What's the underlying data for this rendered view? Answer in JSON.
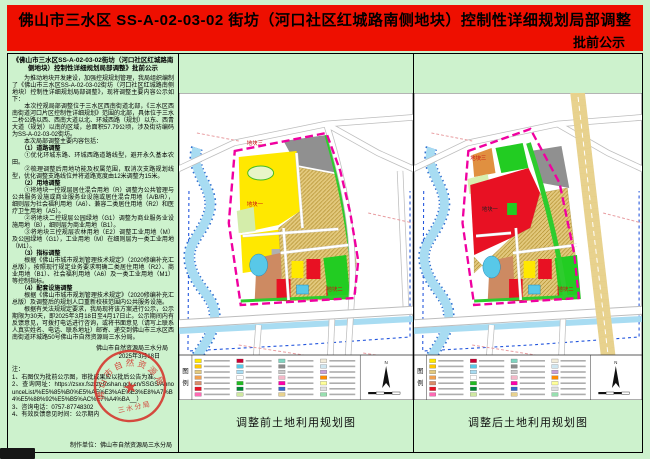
{
  "banner": {
    "title": "佛山市三水区 SS-A-02-03-02 街坊（河口社区红城路南侧地块）控制性详细规划局部调整",
    "subtitle": "批前公示"
  },
  "notice": {
    "heading": "《佛山市三水区SS-A-02-03-02街坊（河口社区红城路南侧地块）控制性详细规划局部调整》批前公示",
    "body": [
      "　　为推动地块开发建设，加强控规规划管理，我局组织编制了《佛山市三水区SS-A-02-03-02街坊（河口社区红城路南侧地块）控制性详细规划局部调整》，现将调整主要内容公示如下：",
      "　　本次控规局部调整位于三水区西南街道北部，《三水区西南街道河口片区控制性详细规划》范围的北部，具体位于三水二桥公路以西、西南大道以北、环城西路（规划）以东、西青大道（规划）以南的区域，总面积57.79公顷，涉及街坊编码为SS-A-02-03-02街坊。",
      "　　本次局部调整主要内容包括：",
      "　　（1）道路调整",
      "　　①优化环城东路、环城西路道路线型，避开永久基本农田。",
      "　　②梳理调整后用地功能及权属范围，取消次支路规划线型，优化调整支路线位并将道路宽度由12米调整为15米。",
      "　　（2）用地调整",
      "　　①将地块一控规层居住混合用地（R）调整为公共管理与公共服务设施或商业服务业设施或居住混合用地（A/B/R），细则层为社会福利用地（A6）、兼容二类居住用地（R2）和医疗卫生用地（A5）。",
      "　　②将地块二控规层公园绿地（G1）调整为商业服务业设施用地（B），细则层为商业用地（B1）。",
      "　　③将地块三控规层农林用地（E2）调整工业用地（M）及公园绿地（G1），工业用地（M）在细则层为一类工业用地（M1）。",
      "　　（3）指标调整",
      "　　根据《佛山市城市规划管理技术规定》（2020修编补充汇总版），按照现行规定业务要求明确二类居住用地（R2）、商业用地（B1）、社会福利用地（A6）及一类工业用地（M1）等控制指标。",
      "　　（4）配套设施调整",
      "　　根据《佛山市城市规划管理技术规定》（2020修编补充汇总版）及调整后的规划人口重新校核范围内公共服务设施。",
      "　　根据有关法规规定要求，我局现将该方案进行公示，公示期限为30天，即2025年3月18日至4月17日止。公示期间内有反馈意见，可拨打电话进行咨询，或将书面意见（请写上联系人真实姓名、电话、联系地址）邮寄、递交到佛山市三水区西南街道环城路50号佛山市自然资源局三水分局。"
    ],
    "sign_org": "佛山市自然资源局三水分局",
    "sign_date": "2025年3月18日",
    "seal_arc": "佛山市自然资源局",
    "seal_bottom": "三水分局",
    "notes_title": "注：",
    "notes": [
      "1、右图仅为批前公示图，审批成果应以批后公告为准。",
      "2、查询网址：https://zsxx.fszrzy.foshan.gov.cn/SSGS/AnnounceList/%E5%85%B0%E5%AE%E3%AE%E3%E8%A7%B4%E5%88%92%E5%B5%AC%E7%A4%BA__）",
      "3、咨询电话：0757-87748302",
      "4、有效反馈意见时间：公示期内"
    ],
    "maker": "制作单位：佛山市自然资源局三水分局"
  },
  "maps": {
    "legend_char1": "图",
    "legend_char2": "例",
    "north_label": "N",
    "before": {
      "caption": "调整前土地利用规划图",
      "plot1": "地块一",
      "plot2": "地块二",
      "plot3": "地块三"
    },
    "after": {
      "caption": "调整后土地利用规划图",
      "plot1": "地块一",
      "plot2": "地块二",
      "plot3": "地块三"
    },
    "legend_colors": [
      "#ffe800",
      "#ffc800",
      "#e3c97e",
      "#f0a050",
      "#d98c6a",
      "#e81123",
      "#ff69b4",
      "#cc0033",
      "#58c8e8",
      "#a8dcf2",
      "#ffffff",
      "#22bb22",
      "#008833",
      "#cfe8a0",
      "#7fd4c0",
      "#8c8c8c",
      "#c8c8c8",
      "#f4b8c8",
      "#ff00aa",
      "#3366cc",
      "#e8d28e",
      "#f2ecd8",
      "#cfe6f0",
      "#c8a0d8",
      "#ff8c00",
      "#ffff99",
      "#e0e0e0",
      "#98e0b0"
    ]
  },
  "colors": {
    "page_bg": "#cdf2cd",
    "banner_bg": "#ee0f00",
    "boundary_magenta": "#f000a0",
    "seal_red": "#d5332b",
    "parcel_yellow": "#ffe800",
    "parcel_red": "#e81123",
    "parcel_green": "#22cc22",
    "parcel_grey": "#909090",
    "parcel_tan": "#e2c87c",
    "parcel_brown": "#cd8a62",
    "water_blue": "#a8dcf2"
  }
}
